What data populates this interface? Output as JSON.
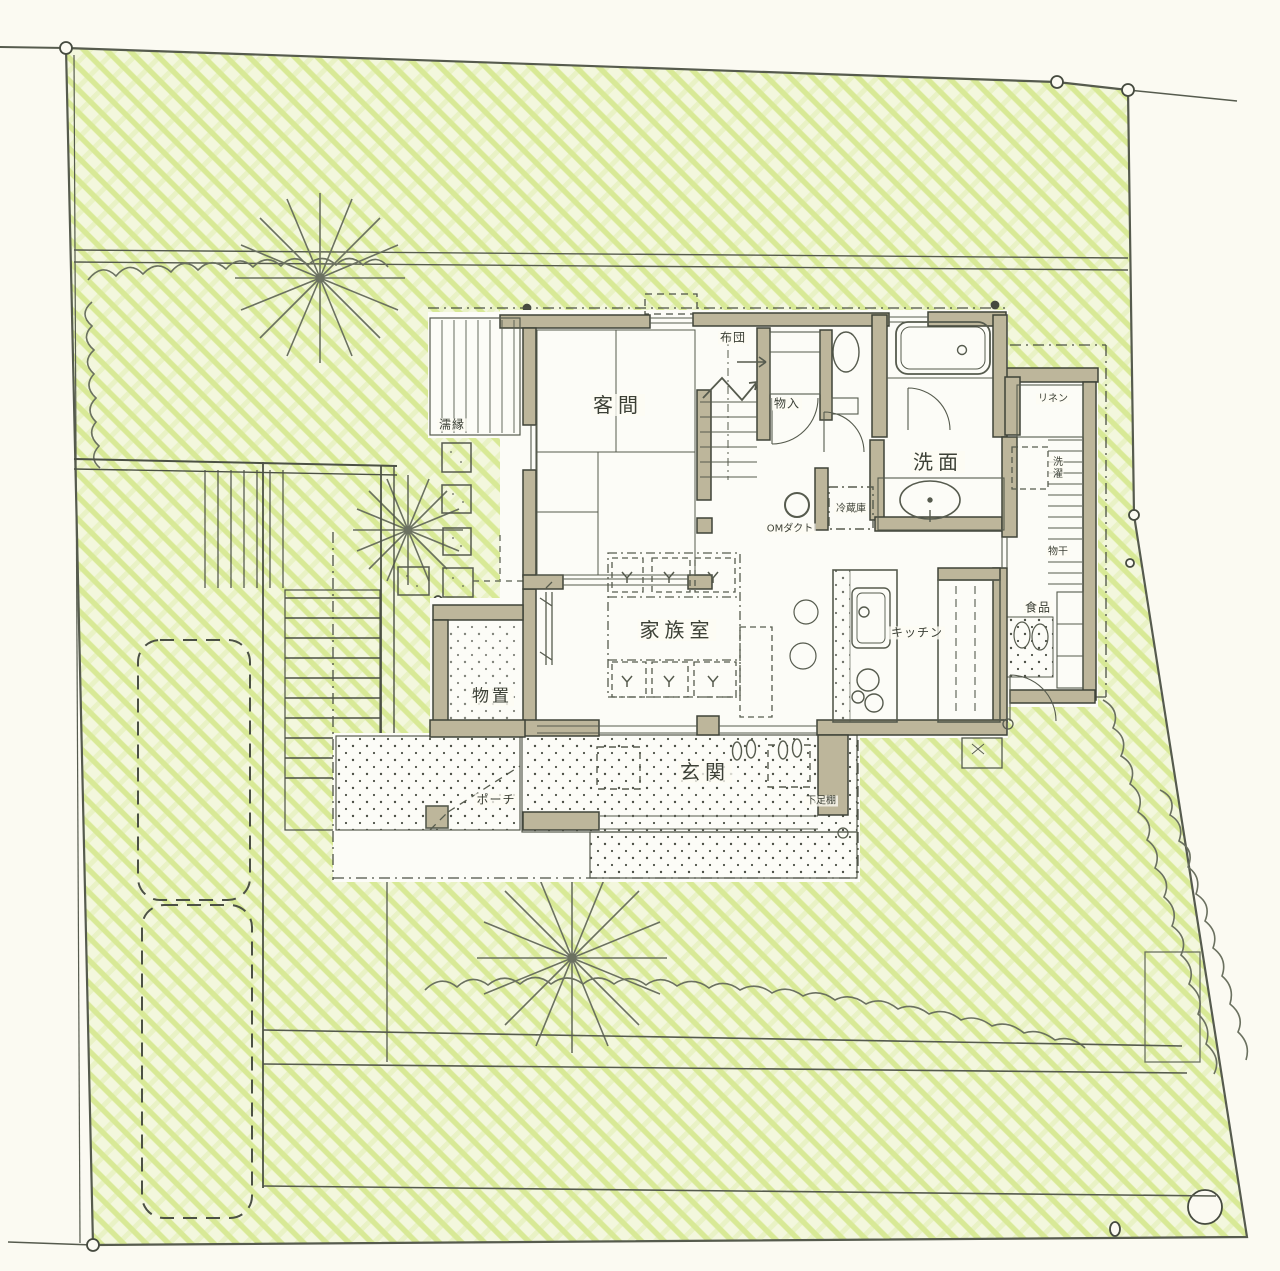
{
  "drawing": {
    "type": "hand-drawn site and floor plan",
    "colors": {
      "paper": "#fbfaf2",
      "garden_hatch": "#cde47f",
      "garden_base": "#f3f7dd",
      "pencil_line": "#565b4e",
      "wall_fill": "#bdb69b",
      "text": "#3c4036"
    }
  },
  "labels": {
    "veranda": "濡縁",
    "guest_room": "客間",
    "futon": "布団",
    "closet": "物入",
    "washroom": "洗面",
    "linen": "リネン",
    "laundry": "洗濯",
    "drying": "物干",
    "pantry": "食品",
    "refrigerator": "冷蔵庫",
    "om_duct": "OMダクト",
    "family_room": "家族室",
    "kitchen": "キッチン",
    "storage": "物置",
    "entrance": "玄関",
    "porch": "ポーチ",
    "shoe_rack": "下足棚"
  }
}
